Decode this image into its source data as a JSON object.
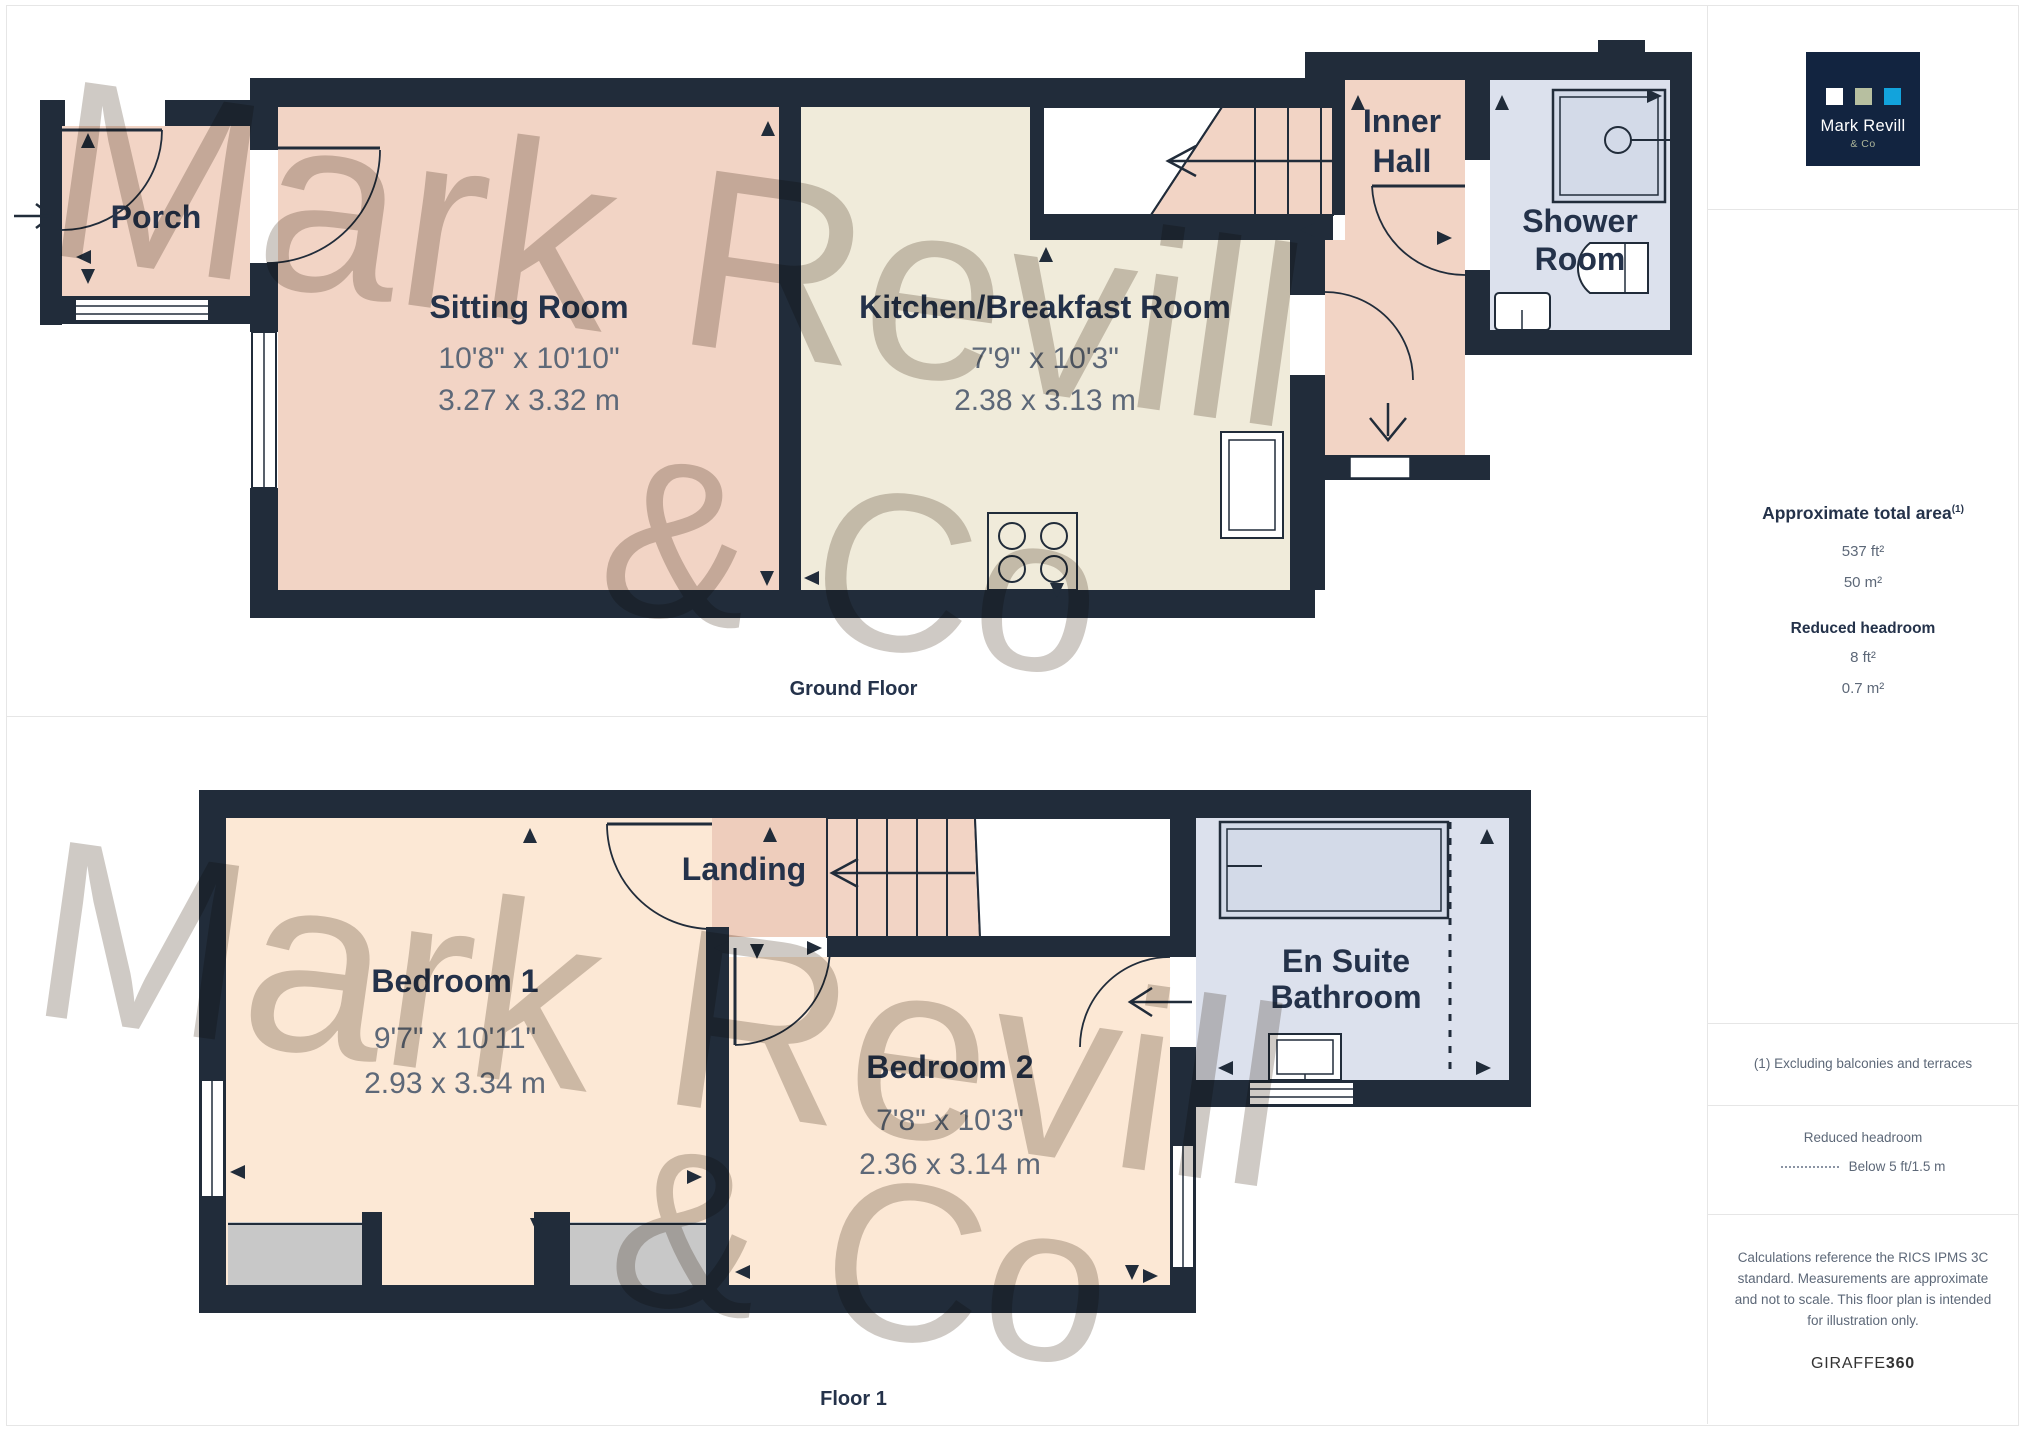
{
  "branding": {
    "logo_line1": "Mark Revill",
    "logo_line2": "& Co",
    "colors": {
      "navy": "#122440",
      "sage": "#b7bfa0",
      "blue": "#12a3dc"
    }
  },
  "theme": {
    "wall": "#212c3a",
    "salmon": "#f2d4c5",
    "landing_salmon": "#eecdbc",
    "peach": "#fce8d5",
    "cream": "#f0ebda",
    "bath_blue": "#dce1ed",
    "fixture_blue": "#d3dae8",
    "alcove_gray": "#c8c8c8",
    "label": "#24324a",
    "dim_text": "#5d6878"
  },
  "watermark": {
    "line1": "Mark Revill",
    "line2": "& Co"
  },
  "ground": {
    "caption": "Ground Floor",
    "porch": {
      "name": "Porch"
    },
    "sitting": {
      "name": "Sitting Room",
      "imperial": "10'8\" x 10'10\"",
      "metric": "3.27 x 3.32 m"
    },
    "kitchen": {
      "name": "Kitchen/Breakfast Room",
      "imperial": "7'9\" x 10'3\"",
      "metric": "2.38 x 3.13 m"
    },
    "inner_hall": {
      "line1": "Inner",
      "line2": "Hall"
    },
    "shower": {
      "line1": "Shower",
      "line2": "Room"
    }
  },
  "floor1": {
    "caption": "Floor 1",
    "landing": {
      "name": "Landing"
    },
    "bedroom1": {
      "name": "Bedroom 1",
      "imperial": "9'7\" x 10'11\"",
      "metric": "2.93 x 3.34 m"
    },
    "bedroom2": {
      "name": "Bedroom 2",
      "imperial": "7'8\" x 10'3\"",
      "metric": "2.36 x 3.14 m"
    },
    "ensuite": {
      "line1": "En Suite",
      "line2": "Bathroom"
    }
  },
  "sidebar": {
    "area": {
      "title": "Approximate total area",
      "superscript": "(1)",
      "values": [
        "537 ft²",
        "50 m²"
      ],
      "reduced_title": "Reduced headroom",
      "reduced_values": [
        "8 ft²",
        "0.7 m²"
      ]
    },
    "footnote": "(1) Excluding balconies and terraces",
    "legend": {
      "title": "Reduced headroom",
      "dash_label": "Below 5 ft/1.5 m"
    },
    "disclaimer": "Calculations reference the RICS IPMS 3C standard. Measurements are approximate and not to scale. This floor plan is intended for illustration only.",
    "credit": {
      "brand": "GIRAFFE",
      "suffix": "360"
    }
  }
}
